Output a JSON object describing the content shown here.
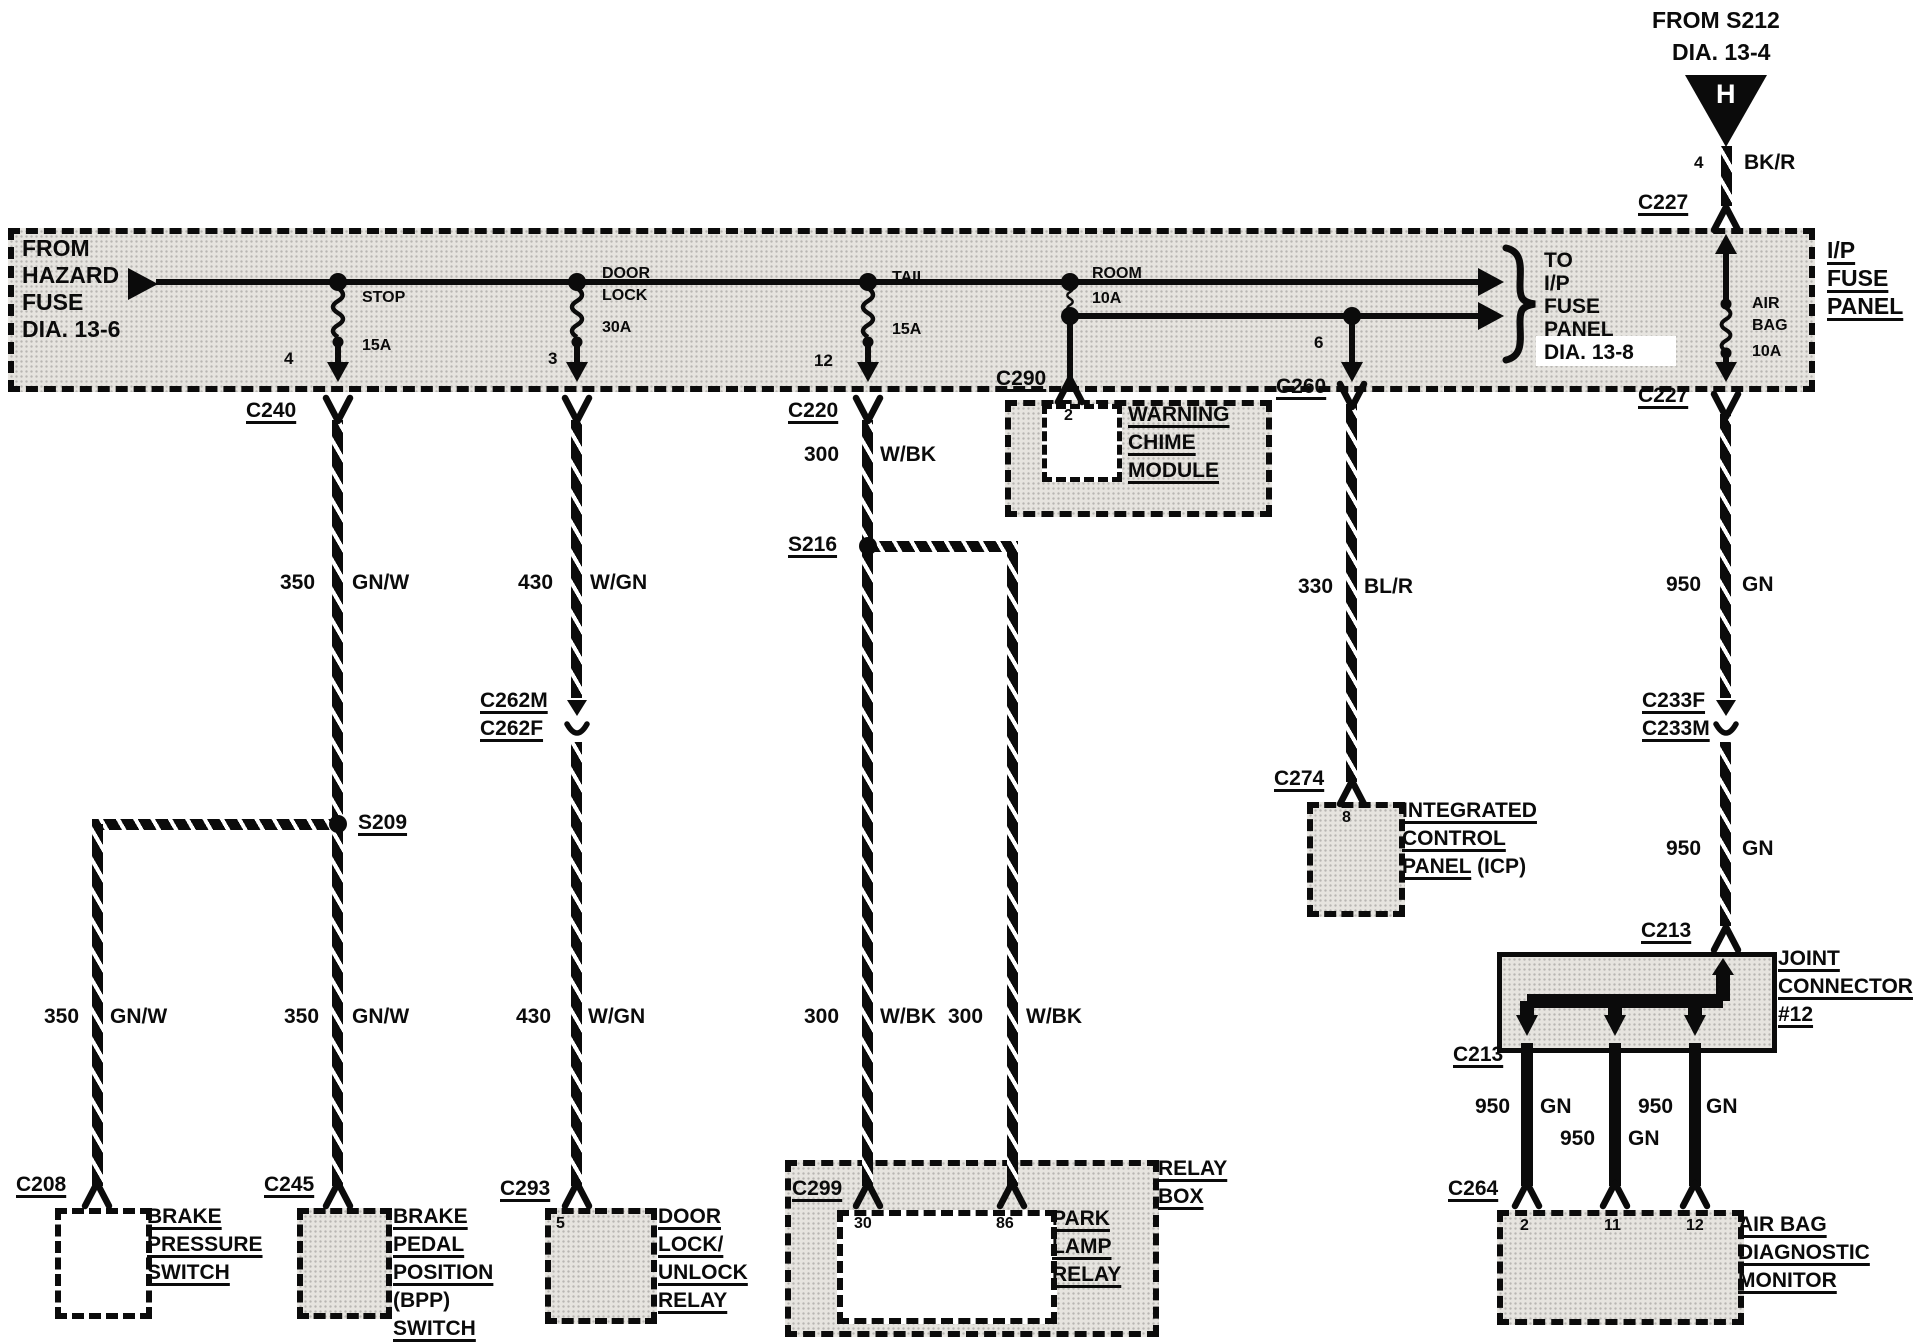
{
  "source_top": {
    "line1": "FROM S212",
    "line2": "DIA. 13-4",
    "code": "H",
    "pin": "4",
    "circuit": "BK/R",
    "connector": "C227"
  },
  "fuse_panel": {
    "name_lines": [
      "I/P",
      "FUSE",
      "PANEL"
    ],
    "from_lines": [
      "FROM",
      "HAZARD",
      "FUSE",
      "DIA. 13-6"
    ],
    "to_lines": [
      "TO",
      "I/P",
      "FUSE",
      "PANEL",
      "DIA. 13-8"
    ],
    "fuses": {
      "stop": {
        "name": "STOP",
        "rating": "15A",
        "pin": "4"
      },
      "door_lock": {
        "name1": "DOOR",
        "name2": "LOCK",
        "rating": "30A",
        "pin": "3"
      },
      "tail": {
        "name": "TAIL",
        "rating": "15A",
        "pin": "12"
      },
      "room": {
        "name": "ROOM",
        "rating": "10A",
        "branch_pin": "6"
      },
      "air_bag": {
        "name1": "AIR",
        "name2": "BAG",
        "rating": "10A"
      }
    }
  },
  "connectors": {
    "c240": "C240",
    "c220": "C220",
    "c290": "C290",
    "c260": "C260",
    "c227": "C227",
    "c262m": "C262M",
    "c262f": "C262F",
    "c233f": "C233F",
    "c233m": "C233M",
    "c274": "C274",
    "c213": "C213",
    "c208": "C208",
    "c245": "C245",
    "c293": "C293",
    "c299": "C299",
    "c264": "C264"
  },
  "splices": {
    "s209": "S209",
    "s216": "S216"
  },
  "circuits": {
    "c350": {
      "id": "350",
      "color": "GN/W"
    },
    "c430": {
      "id": "430",
      "color": "W/GN"
    },
    "c300": {
      "id": "300",
      "color": "W/BK"
    },
    "c330": {
      "id": "330",
      "color": "BL/R"
    },
    "c950": {
      "id": "950",
      "color": "GN"
    }
  },
  "components": {
    "warning_chime": {
      "pin": "2",
      "lines": [
        "WARNING",
        "CHIME",
        "MODULE"
      ]
    },
    "icp": {
      "pin": "8",
      "lines": [
        "INTEGRATED",
        "CONTROL",
        "PANEL"
      ],
      "suffix": " (ICP)"
    },
    "joint_connector": {
      "lines": [
        "JOINT",
        "CONNECTOR",
        "#12"
      ]
    },
    "air_bag_monitor": {
      "pins": [
        "2",
        "11",
        "12"
      ],
      "lines": [
        "AIR BAG",
        "DIAGNOSTIC",
        "MONITOR"
      ]
    },
    "brake_pressure_switch": {
      "lines": [
        "BRAKE",
        "PRESSURE",
        "SWITCH"
      ]
    },
    "bpp_switch": {
      "lines": [
        "BRAKE",
        "PEDAL",
        "POSITION",
        "(BPP)",
        "SWITCH"
      ]
    },
    "door_lock_relay": {
      "pin": "5",
      "lines": [
        "DOOR",
        "LOCK/",
        "UNLOCK",
        "RELAY"
      ]
    },
    "park_lamp_relay": {
      "pin_left": "30",
      "pin_right": "86",
      "lines": [
        "PARK",
        "LAMP",
        "RELAY"
      ]
    },
    "relay_box": {
      "lines": [
        "RELAY",
        "BOX"
      ]
    }
  },
  "colors": {
    "ink": "#0b0b0b",
    "paper": "#ffffff",
    "shade": "#e6e4df"
  }
}
